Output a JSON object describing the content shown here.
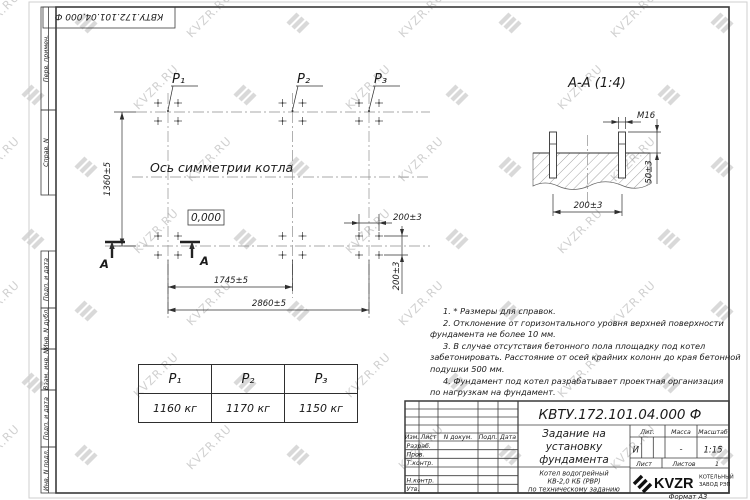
{
  "watermark": {
    "text": "KVZR.RU"
  },
  "corner_stamp": {
    "doc_number": "КВТУ.172.101.04.000  Ф"
  },
  "margin_labels": {
    "perv_primen": "Перв. примен.",
    "sprav_n": "Справ. N",
    "podp_data_1": "Подп. и дата",
    "inv_dubl": "Инв. N дубл.",
    "vzam_inv": "Взам. инв. N",
    "podp_data_2": "Подп. и дата",
    "inv_podl": "Инв. N подл."
  },
  "plan": {
    "p1": "P₁",
    "p2": "P₂",
    "p3": "P₃",
    "axis_label": "Ось симметрии котла",
    "level_mark": "0,000",
    "dim_height": "1360±5",
    "dim_span_1": "1745±5",
    "dim_span_2": "2860±5",
    "dim_bolt_h": "200±3",
    "dim_bolt_v": "200±3",
    "section_letter": "А"
  },
  "section_view": {
    "title": "А-А (1:4)",
    "dim_thread": "М16",
    "dim_protrusion": "50±3",
    "dim_spacing": "200±3"
  },
  "notes": {
    "lines": [
      "1. * Размеры для справок.",
      "2. Отклонение от горизонтального уровня верхней поверхности",
      "фундамента не более 10 мм.",
      "3. В случае отсутствия бетонного пола площадку под котел",
      "забетонировать. Расстояние от осей крайних колонн до края бетонной",
      "подушки 500 мм.",
      "4. Фундамент под котел разрабатывает проектная организация",
      "по нагрузкам на фундамент."
    ]
  },
  "load_table": {
    "headers": [
      "P₁",
      "P₂",
      "P₃"
    ],
    "values": [
      "1160 кг",
      "1170 кг",
      "1150 кг"
    ]
  },
  "title_block": {
    "doc_number": "КВТУ.172.101.04.000  Ф",
    "title_lines": [
      "Задание на",
      "установку",
      "фундамента"
    ],
    "product_lines": [
      "Котел водогрейный",
      "КВ-2,0 КБ (РВР)",
      "по техническому заданию"
    ],
    "col_izm": "Изм.",
    "col_list": "Лист",
    "col_dokum": "N докум.",
    "col_podp": "Подп.",
    "col_data": "Дата",
    "row_razrab": "Разраб.",
    "row_prov": "Пров.",
    "row_tkontr": "Т.контр.",
    "row_nkontr": "Н.контр.",
    "row_utv": "Утв.",
    "lit_label": "Лит.",
    "massa_label": "Масса",
    "masshtab_label": "Масштаб",
    "lit_value": "И",
    "massa_value": "-",
    "masshtab_value": "1:15",
    "list_label": "Лист",
    "listov_label": "Листов",
    "listov_value": "1",
    "logo_text": "KVZR",
    "logo_caption_1": "КОТЕЛЬНЫЙ",
    "logo_caption_2": "ЗАВОД РЭП",
    "format_note": "Формат А3"
  }
}
